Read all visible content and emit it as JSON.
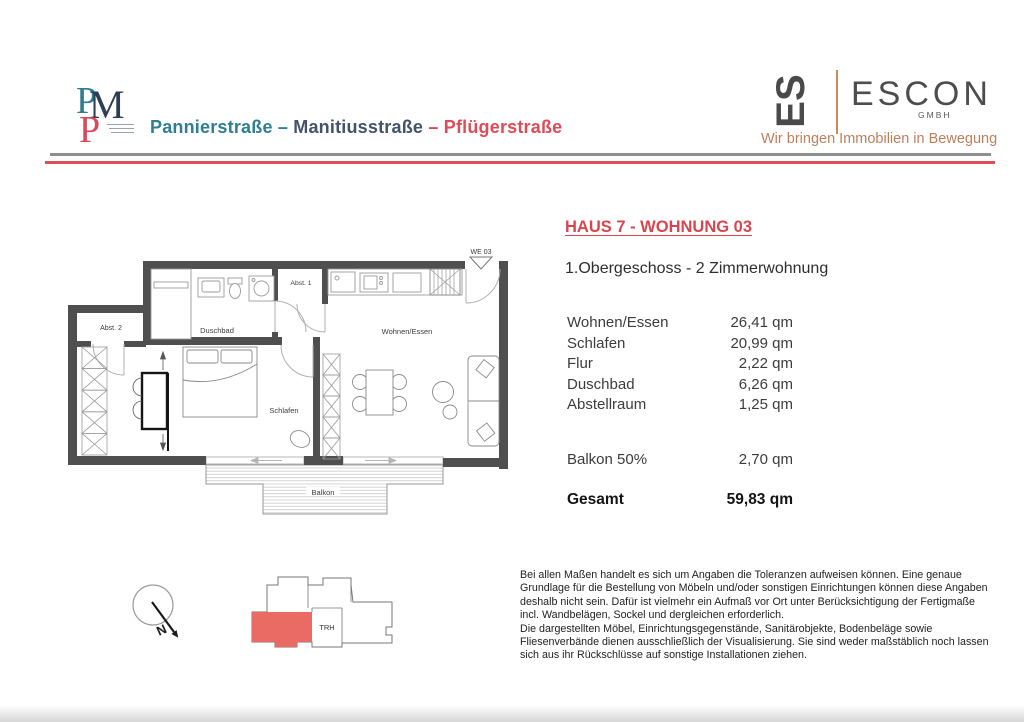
{
  "header": {
    "monogram": {
      "letter_p1": "P",
      "letter_m": "M",
      "letter_p2": "P"
    },
    "project": {
      "street1": "Pannierstraße",
      "dash1": " – ",
      "street2": "Manitiusstraße",
      "dash2": " – ",
      "street3": "Pflügerstraße"
    },
    "escon": {
      "mark": "ES",
      "name": "ESCON",
      "legal": "GMBH",
      "tagline": "Wir bringen Immobilien in Bewegung"
    }
  },
  "unit": {
    "title": "HAUS 7 - WOHNUNG 03",
    "subtitle": "1.Obergeschoss - 2 Zimmerwohnung"
  },
  "areas": {
    "rows": [
      {
        "label": "Wohnen/Essen",
        "value": "26,41 qm"
      },
      {
        "label": "Schlafen",
        "value": "20,99 qm"
      },
      {
        "label": "Flur",
        "value": "2,22 qm"
      },
      {
        "label": "Duschbad",
        "value": "6,26 qm"
      },
      {
        "label": "Abstellraum",
        "value": "1,25 qm"
      }
    ],
    "balcony": {
      "label": "Balkon 50%",
      "value": "2,70 qm"
    },
    "total": {
      "label": "Gesamt",
      "value": "59,83 qm"
    }
  },
  "floorplan": {
    "unit_marker": "WE 03",
    "rooms": {
      "abst2": "Abst. 2",
      "duschbad": "Duschbad",
      "abst1": "Abst. 1",
      "wohnen_essen": "Wohnen/Essen",
      "schlafen": "Schlafen",
      "balkon": "Balkon"
    }
  },
  "keyplan": {
    "stairwell_label": "TRH"
  },
  "compass": {
    "north_label": "N"
  },
  "disclaimer": {
    "lines": [
      "Bei allen Maßen handelt es sich um Angaben die Toleranzen aufweisen können. Eine genaue",
      "Grundlage für die Bestellung von Möbeln und/oder sonstigen Einrichtungen können diese Angaben",
      "deshalb nicht sein. Dafür ist vielmehr ein Aufmaß vor Ort unter Berücksichtigung der Fertigmaße",
      "incl. Wandbelägen, Sockel und dergleichen erforderlich.",
      "Die dargestellten Möbel, Einrichtungsgegenstände, Sanitärobjekte, Bodenbeläge sowie",
      "Fliesenverbände dienen ausschließlich der Visualisierung. Sie sind weder maßstäblich noch lassen",
      "sich aus ihr Rückschlüsse auf sonstige Installationen ziehen."
    ]
  },
  "colors": {
    "accent_red": "#d94f55",
    "teal": "#2e7f93",
    "slate": "#44536b",
    "escon_orange": "#bf7f5b",
    "wall_gray": "#4f4f4f",
    "keyplan_highlight": "#ea6a64"
  }
}
